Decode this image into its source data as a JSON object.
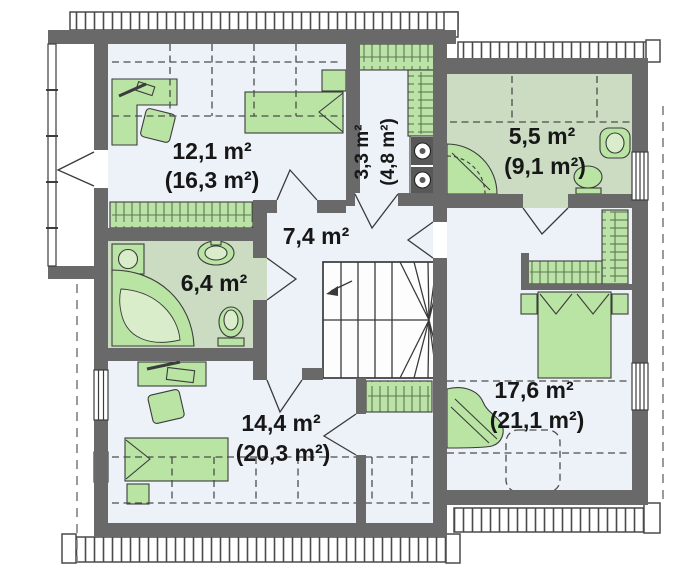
{
  "plan": {
    "rooms": [
      {
        "id": "bedroom-upper-left",
        "area_net": "12,1 m²",
        "area_gross": "(16,3 m²)"
      },
      {
        "id": "wardrobe-laundry",
        "area_net": "3,3 m²",
        "area_gross": "(4,8 m²)"
      },
      {
        "id": "bathroom-upper-right",
        "area_net": "5,5 m²",
        "area_gross": "(9,1 m²)"
      },
      {
        "id": "hallway-stairs",
        "area_net": "7,4 m²",
        "area_gross": ""
      },
      {
        "id": "bathroom-left",
        "area_net": "6,4 m²",
        "area_gross": ""
      },
      {
        "id": "bedroom-lower-left",
        "area_net": "14,4 m²",
        "area_gross": "(20,3 m²)"
      },
      {
        "id": "bedroom-right",
        "area_net": "17,6 m²",
        "area_gross": "(21,1 m²)"
      }
    ],
    "colors": {
      "wall": "#696969",
      "room_floor": "#edf1f8",
      "bath_floor": "#cbdcc3",
      "furniture": "#b9e4a4",
      "closet_hatch": "#bce3a7",
      "outline": "#3c3c3c",
      "background": "#ffffff"
    }
  }
}
